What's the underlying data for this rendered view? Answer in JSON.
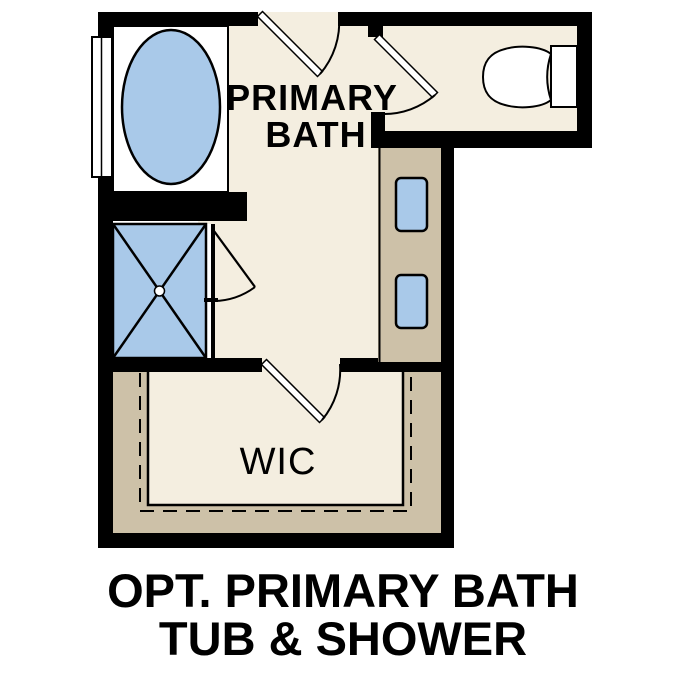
{
  "plan": {
    "bath_label_line1": "PRIMARY",
    "bath_label_line2": "BATH",
    "wic_label": "WIC"
  },
  "caption": {
    "line1": "OPT. PRIMARY BATH",
    "line2": "TUB & SHOWER"
  },
  "colors": {
    "wall": "#000000",
    "floor": "#f4eee0",
    "millwork": "#cdc1a8",
    "fixture_blue": "#a9c9e9",
    "fixture_white": "#ffffff",
    "line": "#000000"
  }
}
